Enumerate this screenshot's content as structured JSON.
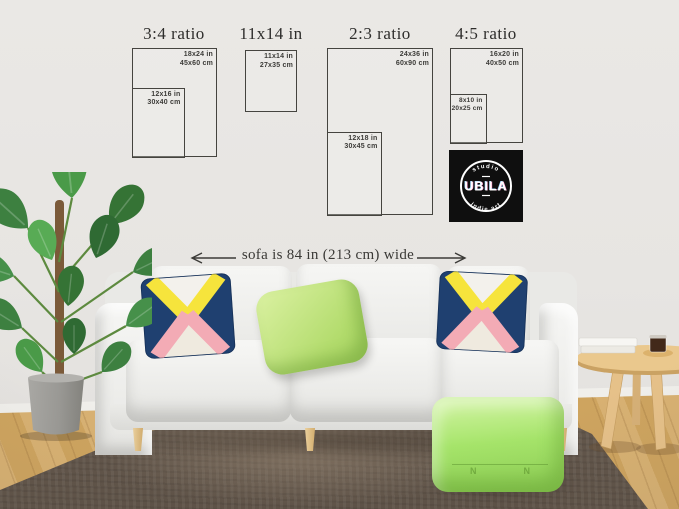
{
  "size_guide": {
    "groups": [
      {
        "heading": "3:4 ratio",
        "outer": {
          "inches": "18x24 in",
          "cm": "45x60 cm"
        },
        "inner": {
          "inches": "12x16 in",
          "cm": "30x40 cm"
        }
      },
      {
        "heading": "11x14 in",
        "outer": {
          "inches": "11x14 in",
          "cm": "27x35 cm"
        }
      },
      {
        "heading": "2:3 ratio",
        "outer": {
          "inches": "24x36 in",
          "cm": "60x90 cm"
        },
        "inner": {
          "inches": "12x18 in",
          "cm": "30x45 cm"
        }
      },
      {
        "heading": "4:5 ratio",
        "outer": {
          "inches": "16x20 in",
          "cm": "40x50 cm"
        },
        "inner": {
          "inches": "8x10 in",
          "cm": "20x25 cm"
        }
      }
    ]
  },
  "logo": {
    "top": "studio",
    "name": "UBILA",
    "bottom": "indie art"
  },
  "annotation": {
    "sofa_width": "sofa is 84 in (213 cm) wide"
  },
  "pouf": {
    "stitch_left": "N",
    "stitch_right": "N"
  },
  "colors": {
    "wall": "#e8e6e3",
    "frame_line": "#45443f",
    "heading_text": "#2e2d2b",
    "logo_bg": "#0f0f0f",
    "logo_text": "#ffffff",
    "pillow_navy": "#1f4070",
    "pillow_yellow": "#f6e43c",
    "pillow_pink": "#f3abb5",
    "pillow_green": "#c9e88c",
    "pouf_green": "#a6e56a",
    "rug": "#6a5e53",
    "floor_wood": "#d2a967",
    "sofa": "#f3f3f1",
    "wood_legs": "#e2c08a",
    "plant_green": "#3d8040",
    "pot_gray": "#9a9995"
  }
}
